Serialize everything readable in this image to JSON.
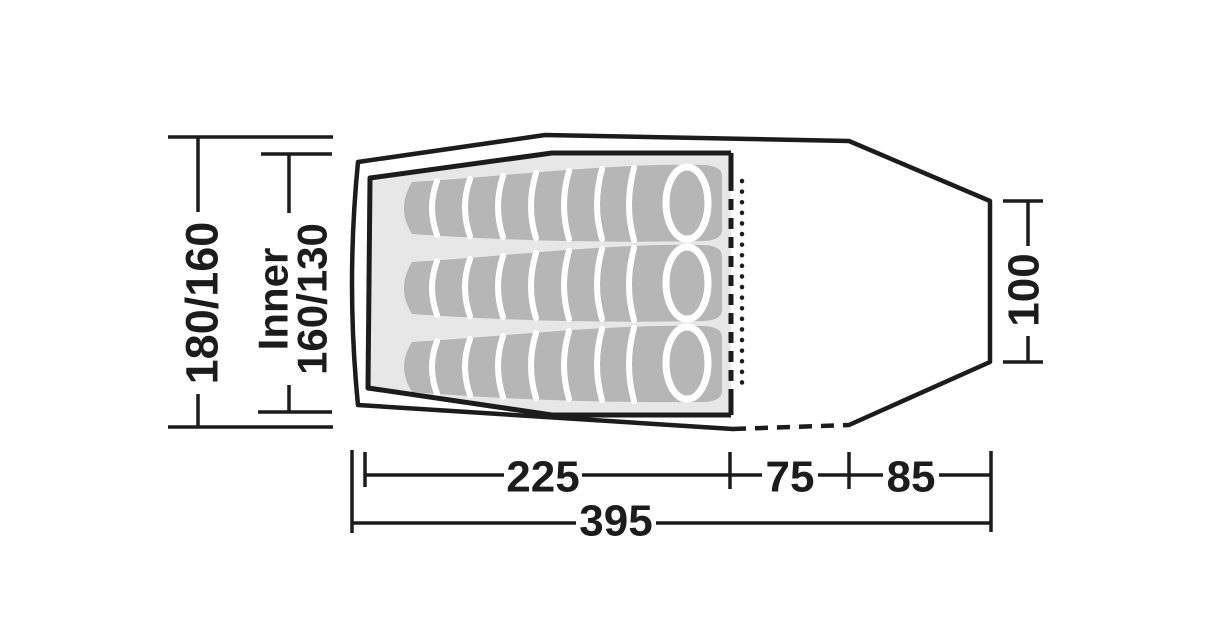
{
  "figure": {
    "description": "Tent floor plan diagram, top view, with three sleeping bags in the inner tent and dimension lines",
    "colors": {
      "line": "#1c1c1c",
      "inner_floor": "#e7e7e7",
      "sleeping_bag": "#b6b6b6",
      "stripe": "#ffffff",
      "background": "#ffffff"
    },
    "dimensions": {
      "outer_width": "180/160",
      "inner_label": "Inner",
      "inner_width": "160/130",
      "rear_width": "100",
      "inner_length": "225",
      "porch_length": "75",
      "rear_length": "85",
      "total_length": "395"
    }
  }
}
